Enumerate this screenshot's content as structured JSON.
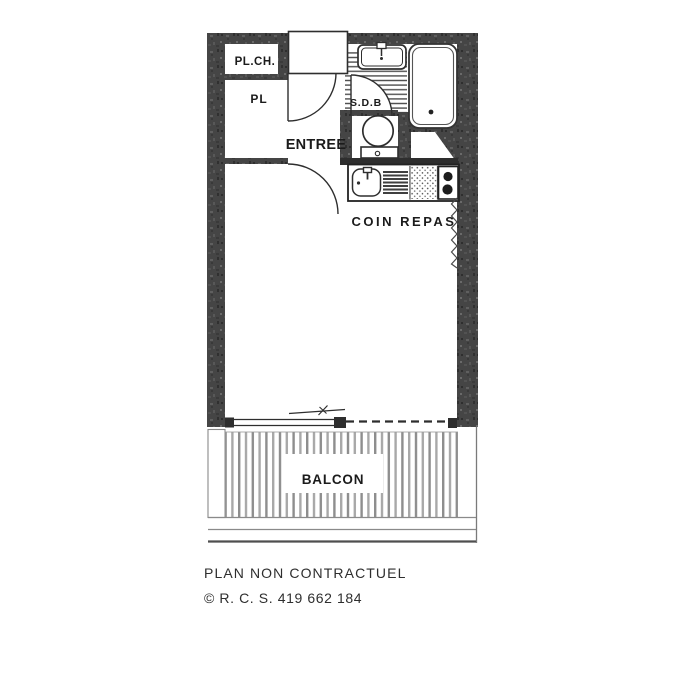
{
  "plan": {
    "rooms": {
      "pl_ch": "PL.CH.",
      "pl": "PL",
      "entree": "ENTREE",
      "sdb": "S.D.B",
      "coin_repas": "COIN REPAS",
      "balcon": "BALCON"
    },
    "footer": {
      "disclaimer": "PLAN NON CONTRACTUEL",
      "copyright": "© R. C. S. 419 662 184"
    },
    "colors": {
      "wall": "#454545",
      "line": "#2e2e2e",
      "hatch": "#4d4d4d",
      "balcony_stripe": "#9a9a9a",
      "label_text": "#1b1b1b",
      "footer_text": "#2e2e2e",
      "background": "#ffffff"
    }
  }
}
